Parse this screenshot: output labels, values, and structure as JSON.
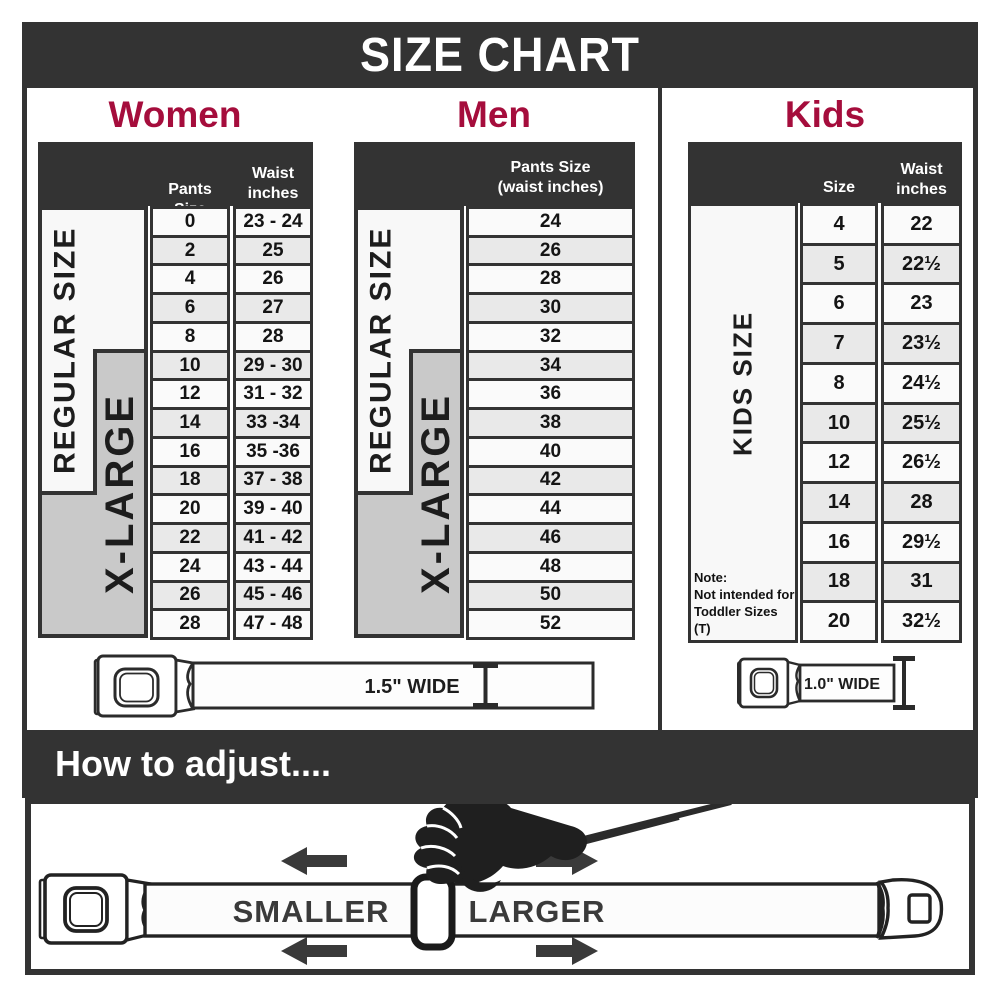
{
  "title": "SIZE CHART",
  "colors": {
    "accent": "#a50d3c",
    "dark": "#333333",
    "xlarge_gray": "#c9c9c9",
    "row_alt": "#e9e9e9"
  },
  "sections": {
    "women": {
      "heading": "Women",
      "col1_header": "Pants Size",
      "col2_header": "Waist\ninches",
      "regular_label": "REGULAR SIZE",
      "xlarge_label": "X-LARGE",
      "rows": [
        [
          "0",
          "23 - 24"
        ],
        [
          "2",
          "25"
        ],
        [
          "4",
          "26"
        ],
        [
          "6",
          "27"
        ],
        [
          "8",
          "28"
        ],
        [
          "10",
          "29 - 30"
        ],
        [
          "12",
          "31 - 32"
        ],
        [
          "14",
          "33 -34"
        ],
        [
          "16",
          "35 -36"
        ],
        [
          "18",
          "37 - 38"
        ],
        [
          "20",
          "39 - 40"
        ],
        [
          "22",
          "41 - 42"
        ],
        [
          "24",
          "43 - 44"
        ],
        [
          "26",
          "45 - 46"
        ],
        [
          "28",
          "47 - 48"
        ]
      ]
    },
    "men": {
      "heading": "Men",
      "col_header": "Pants Size\n(waist inches)",
      "regular_label": "REGULAR SIZE",
      "xlarge_label": "X-LARGE",
      "rows": [
        "24",
        "26",
        "28",
        "30",
        "32",
        "34",
        "36",
        "38",
        "40",
        "42",
        "44",
        "46",
        "48",
        "50",
        "52"
      ]
    },
    "kids": {
      "heading": "Kids",
      "col1_header": "Size",
      "col2_header": "Waist\ninches",
      "label": "KIDS SIZE",
      "note": "Note:\nNot intended for\nToddler Sizes (T)",
      "rows": [
        [
          "4",
          "22"
        ],
        [
          "5",
          "22½"
        ],
        [
          "6",
          "23"
        ],
        [
          "7",
          "23½"
        ],
        [
          "8",
          "24½"
        ],
        [
          "10",
          "25½"
        ],
        [
          "12",
          "26½"
        ],
        [
          "14",
          "28"
        ],
        [
          "16",
          "29½"
        ],
        [
          "18",
          "31"
        ],
        [
          "20",
          "32½"
        ]
      ]
    }
  },
  "belts": {
    "adult_width_label": "1.5\" WIDE",
    "kids_width_label": "1.0\" WIDE"
  },
  "how_to_adjust": {
    "heading": "How to adjust....",
    "smaller_label": "SMALLER",
    "larger_label": "LARGER"
  }
}
